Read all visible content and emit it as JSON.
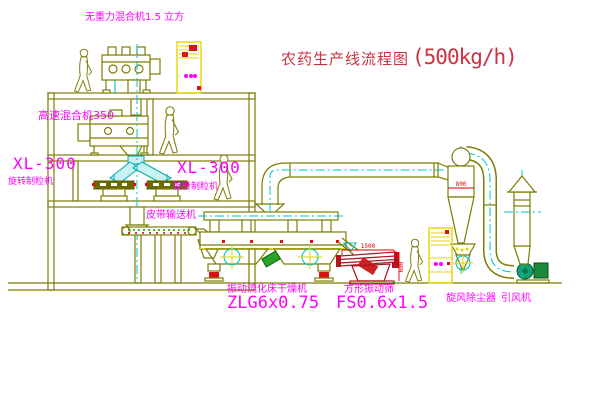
{
  "title": {
    "zh": "农药生产线流程图",
    "capacity": "(500kg/h)"
  },
  "labels": {
    "gravity_mixer": "无重力混合机1.5 立方",
    "high_speed_mixer": "高速混合机350",
    "granulator_model_left": "XL-300",
    "granulator_name_left": "旋转制粒机",
    "granulator_model_right": "XL-300",
    "granulator_name_right": "旋转制粒机",
    "belt_conveyor": "皮带输送机",
    "dryer_name": "振动流化床干燥机",
    "dryer_model": "ZLG6x0.75",
    "screen_name": "方形振动筛",
    "screen_model": "FS0.6x1.5",
    "cyclone": "旋风除尘器",
    "fan": "引风机"
  },
  "dimensions": {
    "screen_length": "1500",
    "cyclone_outlet": "800",
    "screen_height": "600"
  },
  "colors": {
    "line": "#7d7d06",
    "centerline": "#00c4c4",
    "label": "#ff00ff",
    "title": "#cb3340",
    "dimension": "#e00000",
    "cabinet": "#e6d400",
    "fan": "#19a070",
    "screen": "#a81420"
  }
}
